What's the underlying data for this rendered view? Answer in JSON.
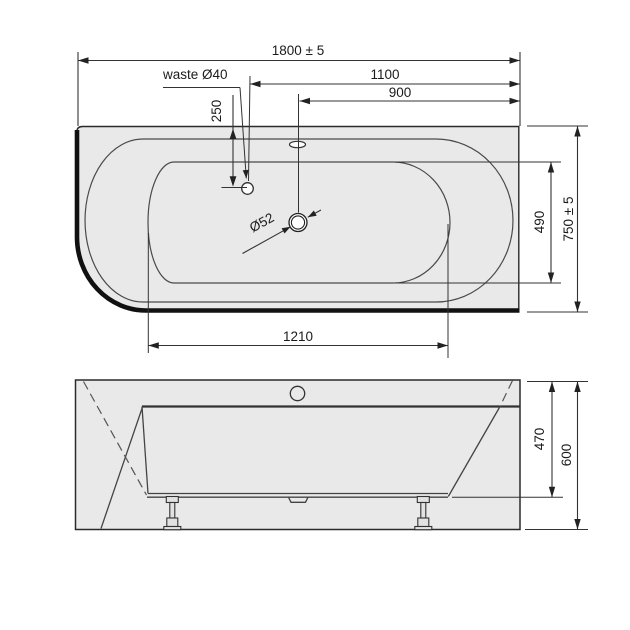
{
  "top_view": {
    "dim_total_length": "1800 ± 5",
    "dim_waste_to_end": "1100",
    "dim_drain_to_end": "900",
    "waste_label": "waste Ø40",
    "dim_waste_from_back_edge": "250",
    "drain_diameter_label": "Ø52",
    "dim_basin_length": "1210",
    "dim_basin_width": "490",
    "dim_total_width": "750 ± 5"
  },
  "side_view": {
    "dim_depth_to_underside": "470",
    "dim_total_height": "600"
  },
  "colors": {
    "paper": "#ffffff",
    "tub_fill": "#e9e9e9",
    "main_line": "#222222",
    "thin_line": "#4a4a4a",
    "text": "#1b1b1b"
  }
}
